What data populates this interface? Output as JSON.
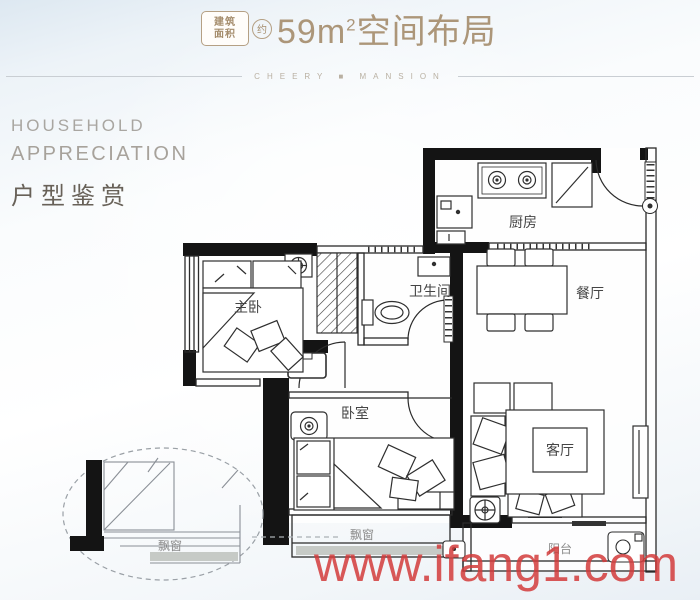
{
  "header": {
    "badge": {
      "line1": "建筑",
      "line2": "面积",
      "approx": "约"
    },
    "area_value": "59m",
    "area_sup": "2",
    "title_suffix": "空间布局",
    "brand": "CHEERY ■ MANSION"
  },
  "intro": {
    "en_line1": "HOUSEHOLD",
    "en_line2": "APPRECIATION",
    "zh_title": "户型鉴赏"
  },
  "rooms": {
    "kitchen": "厨房",
    "dining": "餐厅",
    "bathroom": "卫生间",
    "master_bedroom": "主卧",
    "bedroom": "卧室",
    "living_room": "客厅",
    "balcony": "阳台",
    "bay_window": "飘窗",
    "bay_window_detail": "飘窗"
  },
  "watermark": {
    "text": "www.ifang1.com"
  },
  "colors": {
    "title_tan": "#ac9679",
    "heading_gray": "#a7a29b",
    "heading_dark": "#686158",
    "watermark_red": "#d23b3b",
    "wall_black": "#141414"
  }
}
